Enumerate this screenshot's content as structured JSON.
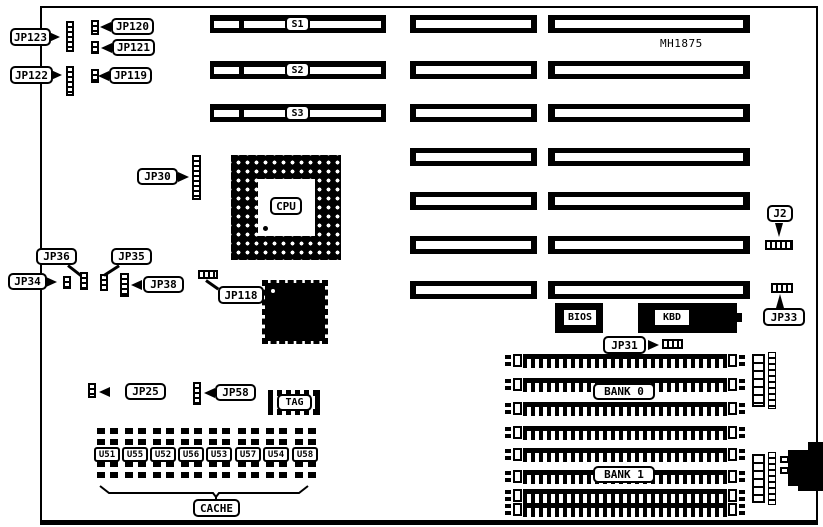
{
  "title": "motherboard-layout-diagram",
  "labels": {
    "jp123": "JP123",
    "jp120": "JP120",
    "jp121": "JP121",
    "jp122": "JP122",
    "jp119": "JP119",
    "jp30": "JP30",
    "jp36": "JP36",
    "jp34": "JP34",
    "jp35": "JP35",
    "jp38": "JP38",
    "jp118": "JP118",
    "j2": "J2",
    "jp33": "JP33",
    "jp31": "JP31",
    "jp25": "JP25",
    "jp58": "JP58",
    "s1": "S1",
    "s2": "S2",
    "s3": "S3",
    "cpu": "CPU",
    "bios": "BIOS",
    "kbd": "KBD",
    "tag": "TAG",
    "bank0": "BANK 0",
    "bank1": "BANK 1",
    "cache": "CACHE",
    "model": "MH1875",
    "u51": "U51",
    "u55": "U55",
    "u52": "U52",
    "u56": "U56",
    "u53": "U53",
    "u57": "U57",
    "u54": "U54",
    "u58": "U58"
  },
  "cache_chip_order": [
    "U51",
    "U55",
    "U52",
    "U56",
    "U53",
    "U57",
    "U54",
    "U58"
  ],
  "memory_banks": {
    "bank0_sockets": 4,
    "bank1_sockets": 4
  },
  "expansion_slots": {
    "left_column": [
      "S1",
      "S2",
      "S3"
    ],
    "middle_column_count": 7,
    "right_column_count": 7
  },
  "colors": {
    "line": "#000000",
    "background": "#ffffff"
  }
}
